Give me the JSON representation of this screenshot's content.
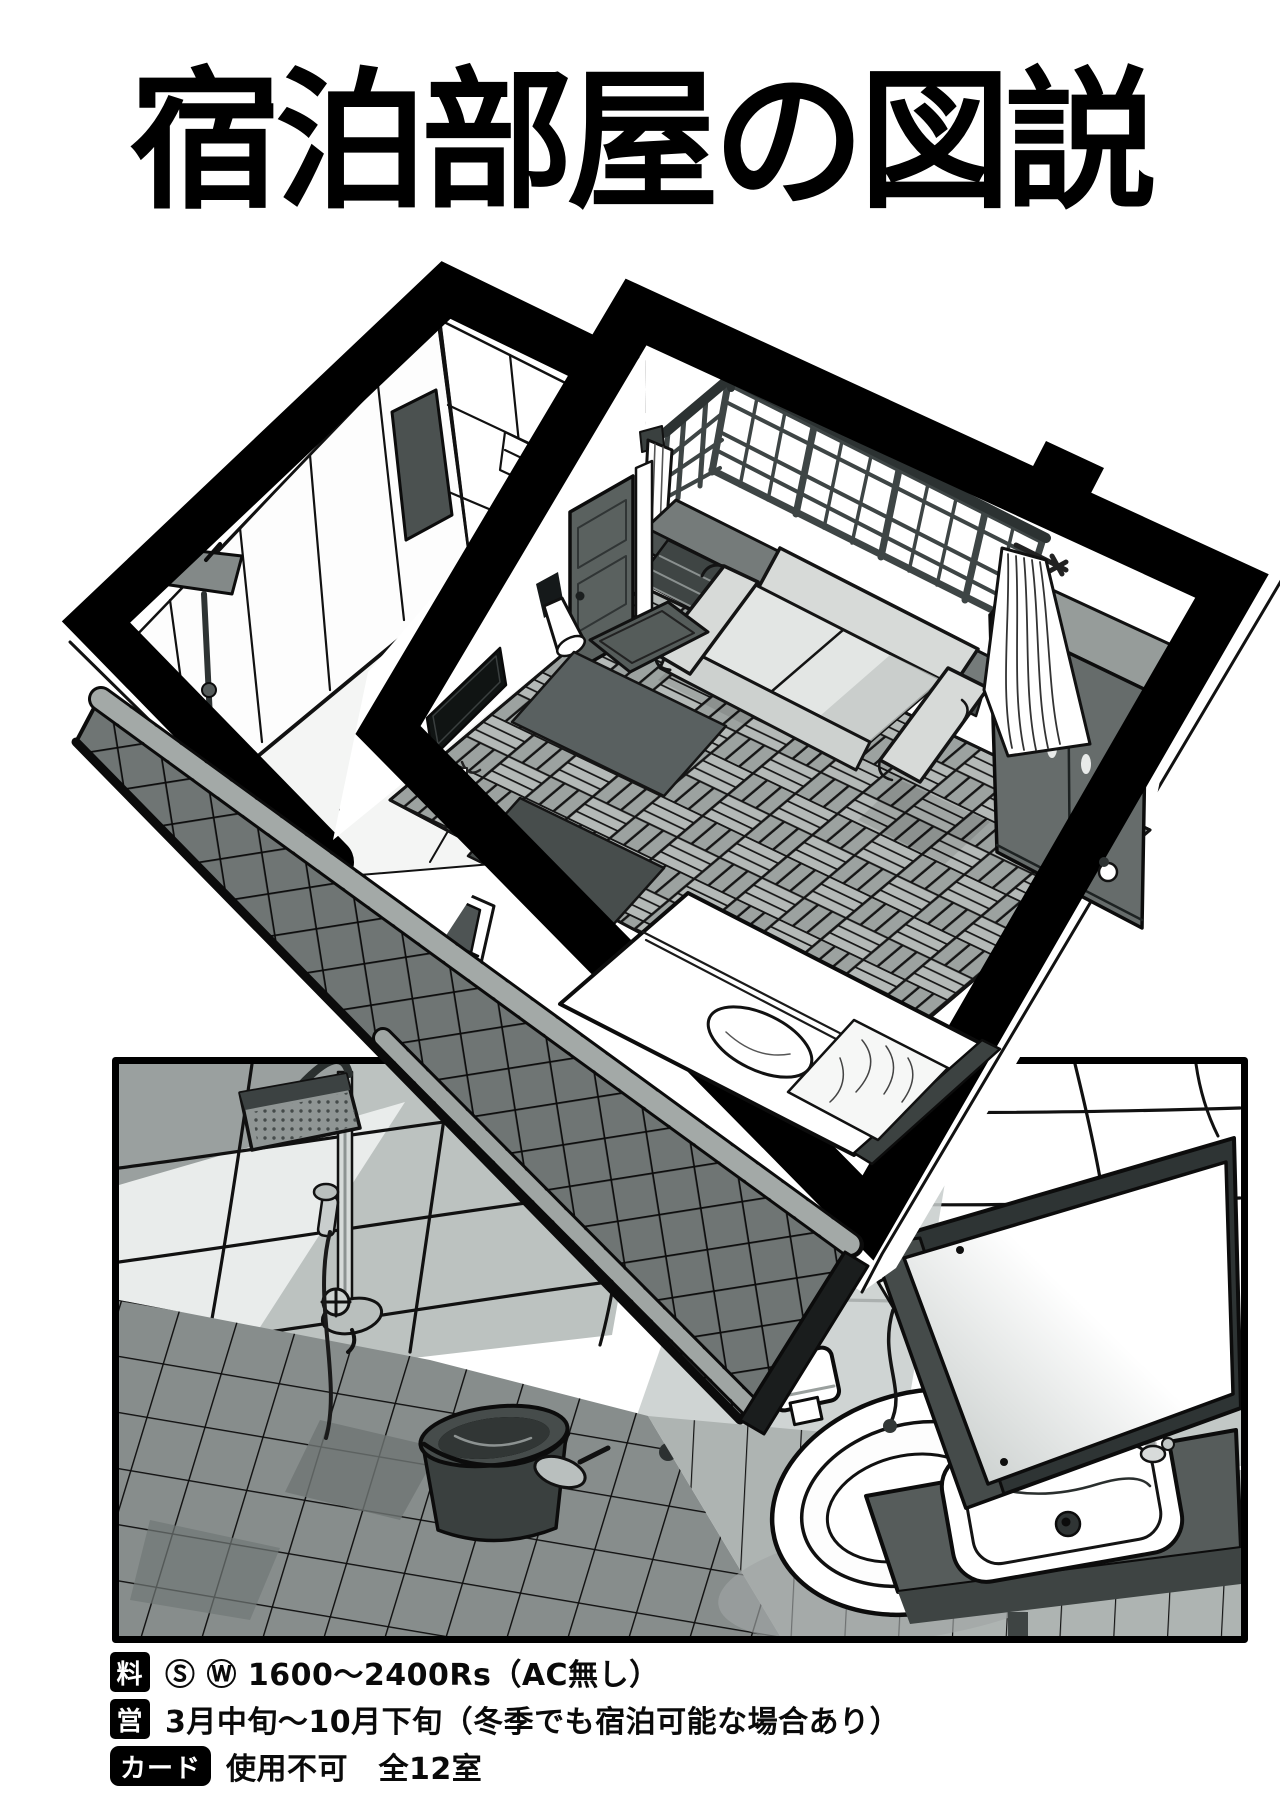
{
  "title": {
    "text": "宿泊部屋の図説"
  },
  "info": {
    "rows": [
      {
        "id": "rate",
        "label": "料",
        "text": "Ⓢ Ⓦ 1600〜2400Rs（AC無し）"
      },
      {
        "id": "season",
        "label": "営",
        "text": "3月中旬〜10月下旬（冬季でも宿泊可能な場合あり）"
      },
      {
        "id": "card",
        "label": "カード",
        "text": "使用不可　全12室"
      }
    ]
  },
  "illustration": {
    "isometric_room_objects": [
      "bathroom-tiled-walls",
      "bathroom-mirror",
      "shower-head",
      "lattice-windows",
      "curtains",
      "rolled-curtain",
      "console-shelf",
      "sofa",
      "wardrobe",
      "door",
      "doormat",
      "wall-sconce",
      "tv",
      "parquet-floor",
      "rug",
      "bed",
      "pillow",
      "headboard",
      "tiled-awning",
      "exterior-window"
    ],
    "bathroom_panel_objects": [
      "shower-column",
      "shower-head",
      "mixer-valve",
      "hand-sprayer",
      "bucket",
      "scoop",
      "floor-drain",
      "toilet",
      "toilet-tank",
      "toilet-paper-holder",
      "bidet-sprayer",
      "sink",
      "counter",
      "faucet",
      "mirror",
      "tiled-walls",
      "tiled-floor"
    ]
  },
  "colors": {
    "ink": "#000000",
    "paper": "#ffffff",
    "tile_dark": "#6f7574",
    "tile_light": "#a0a6a4",
    "furniture_gray": "#666c6b",
    "sofa_gray": "#d7dad8",
    "floor_gray": "#a9aeac"
  }
}
